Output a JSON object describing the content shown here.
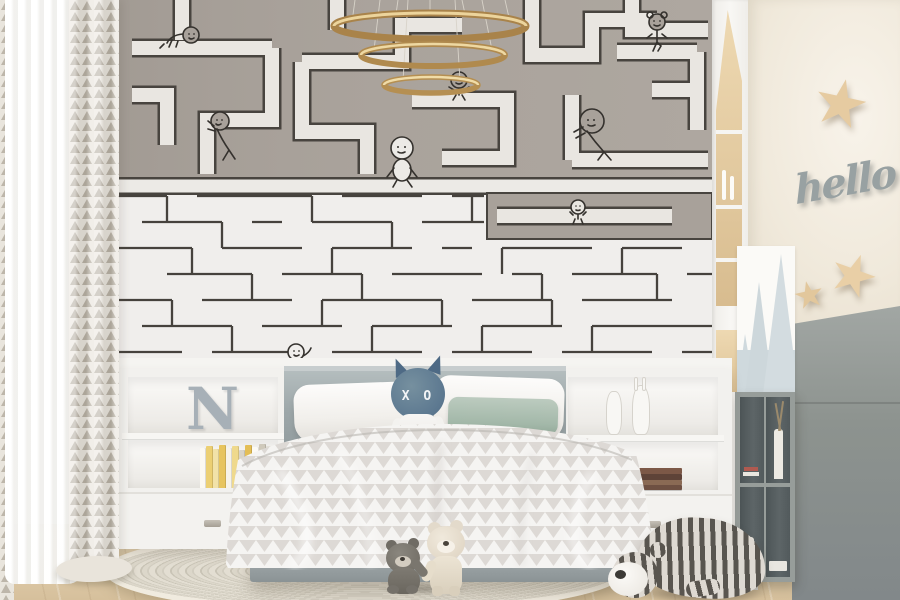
{
  "scene": {
    "room_type": "kids bedroom with maze wallpaper",
    "wall_letter": "N",
    "plush_face_text": "X O",
    "wall_sign_text": "hello"
  },
  "palette": {
    "maze_top_bg": "#a8a19a",
    "maze_path_light": "#e9e6e1",
    "maze_line_dark": "#46423d",
    "maze_bottom_bg": "#f0eeec",
    "chandelier_gold": "#b08a4e",
    "headboard_gray": "#9da7a9",
    "sage_pillow": "#a3b8a9",
    "plush_blue": "#5c7890",
    "duvet_triangle": "#d8d5d0",
    "wood_floor": "#e0cdab",
    "star_wood": "#e6cba1",
    "cabinet_gray": "#8d938f",
    "mountain_decal": "#cfd9dd",
    "hello_sign": "#98a1a2"
  },
  "decor": {
    "chandelier": "three-ring gold pendant light",
    "wall_doodles": [
      "crawling figure",
      "pushing figure",
      "walking figure",
      "hanging figure",
      "leaning figure",
      "small figure",
      "girl figure",
      "peeking figure"
    ],
    "left_shelf_items": [
      "letter N ornament",
      "yellow and white books"
    ],
    "right_shelf_items": [
      "white cat figurine",
      "white bunny figurine",
      "stacked brown books"
    ],
    "toys": [
      "XO horned plush",
      "gray teddy bear",
      "cream teddy bear",
      "striped bear floor plush"
    ],
    "right_wall_items": [
      "wooden star large",
      "wooden star medium",
      "wooden star small",
      "hello script sign",
      "mountain decals"
    ]
  }
}
